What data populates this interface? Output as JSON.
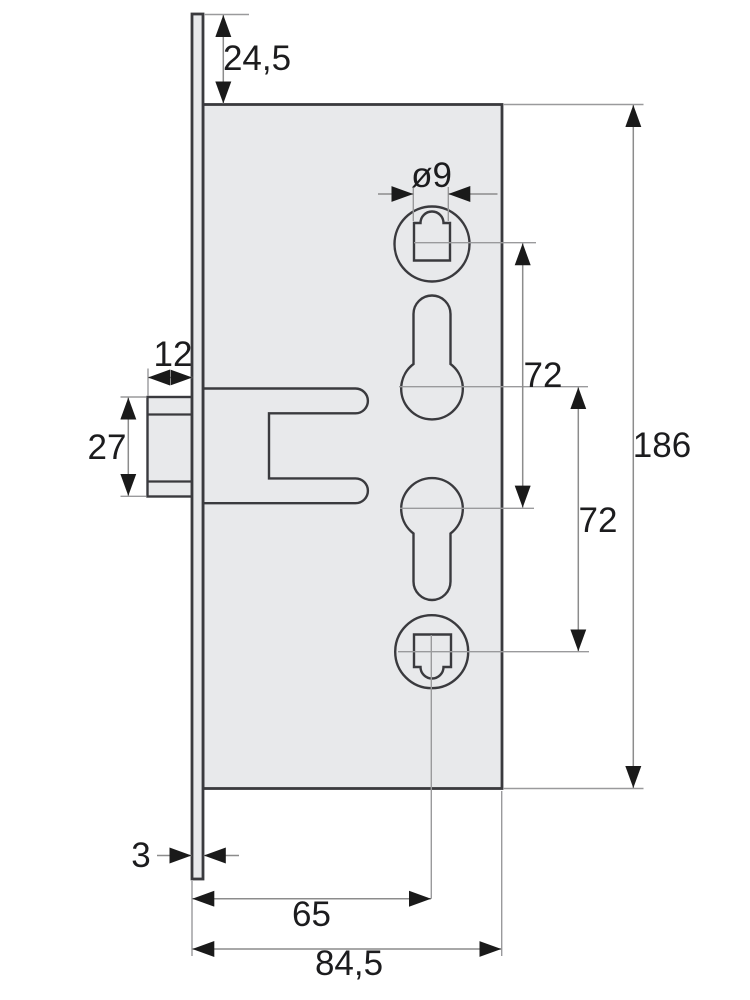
{
  "drawing": {
    "type": "technical-dimension-drawing",
    "subject": "mortise-lock-case-side-view",
    "dimensions": {
      "faceplate_top_to_case": "24,5",
      "follower_square_diameter": "ø9",
      "latch_projection": "12",
      "latch_height": "27",
      "follower_to_cylinder_spacing": "72",
      "cylinder_to_follower_spacing": "72",
      "case_height": "186",
      "faceplate_thickness": "3",
      "backset": "65",
      "overall_depth": "84,5"
    },
    "colors": {
      "background": "#ffffff",
      "part_fill": "#e8e9eb",
      "part_outline": "#3a3a3e",
      "dimension_line": "#8c8c8c",
      "arrowhead": "#1a1a1a",
      "annotation_text": "#1c1c1e"
    }
  }
}
